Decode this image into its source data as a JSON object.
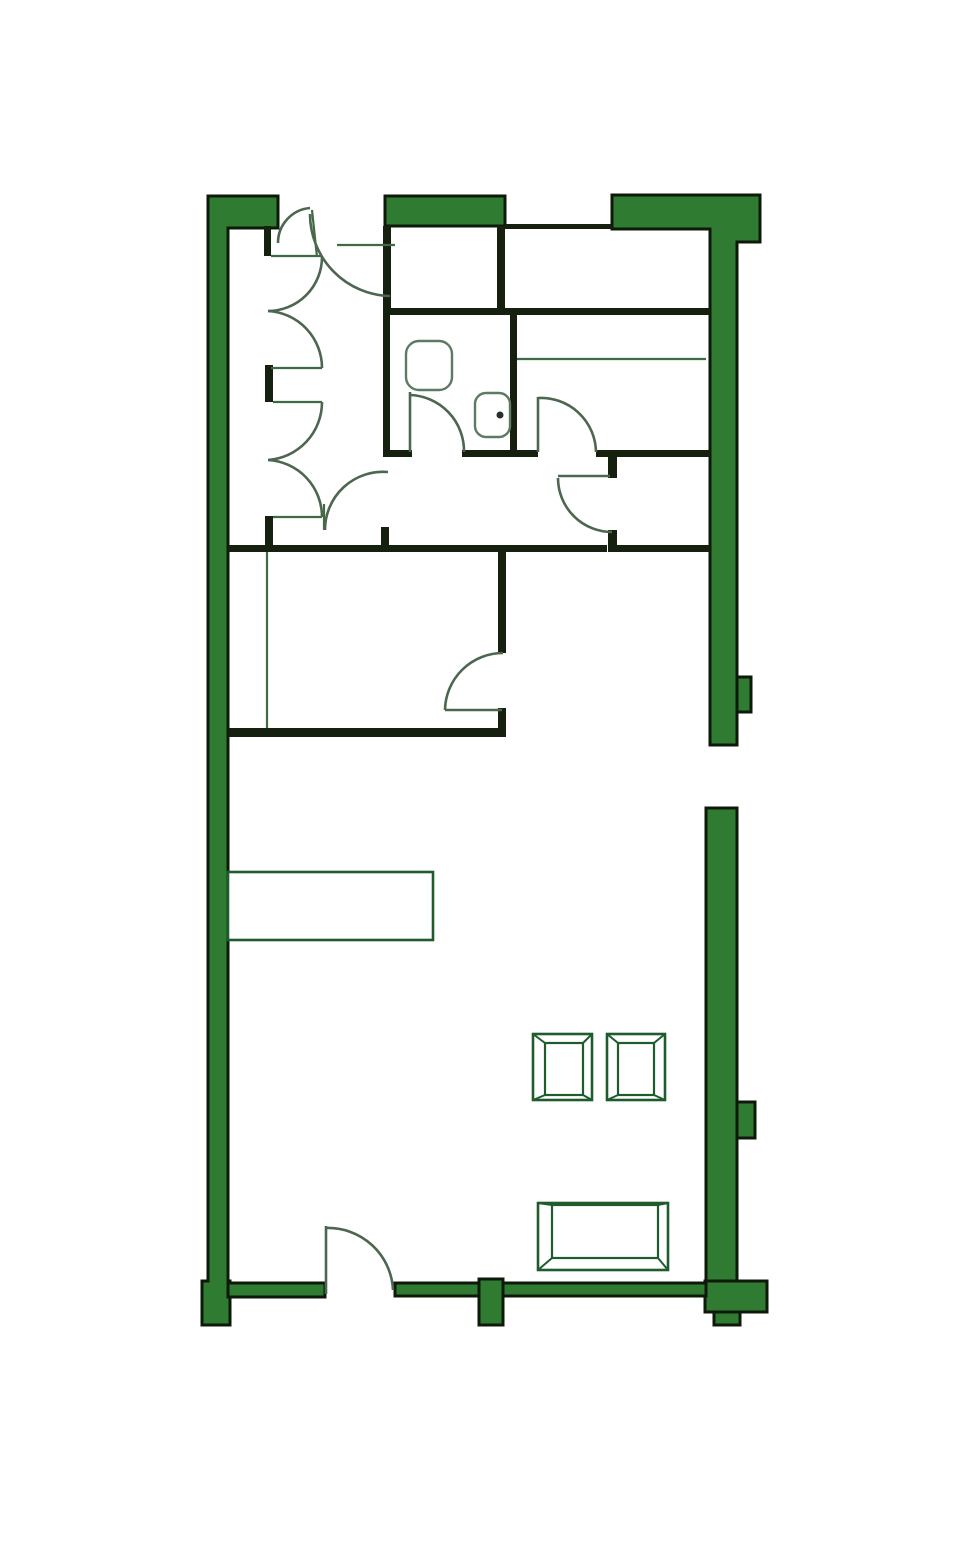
{
  "page": {
    "title": "apartment-floor-plan",
    "background": "#ffffff",
    "width": 980,
    "height": 1568
  },
  "colors": {
    "wall_fill": "#2e7b31",
    "wall_stroke": "#0e1a09",
    "interior_wall": "#16200f",
    "thin_line": "#3f6b43",
    "door": "#4d664f",
    "fixture": "#5d7a62",
    "furniture": "#1f5c2d",
    "faucet_dot": "#26302a",
    "fill_none": "none",
    "white": "#ffffff"
  },
  "floor_plan": {
    "green_walls": [
      {
        "name": "wall-left-exterior",
        "path": "M208,196 L278,196 L278,228 L228,228 L228,1281 L230,1281 L230,1325 L202,1325 L202,1281 L208,1281 Z"
      },
      {
        "name": "wall-top-middle-bar",
        "rect": [
          385,
          196,
          120,
          30
        ]
      },
      {
        "name": "wall-top-right-exterior",
        "path": "M612,195 L760,195 L760,242 L737,242 L737,745 L710,745 L710,229 L612,229 Z"
      },
      {
        "name": "wall-right-pier-upper",
        "rect": [
          737,
          677,
          14,
          35
        ]
      },
      {
        "name": "wall-right-lower-exterior",
        "rect": [
          706,
          808,
          31,
          475
        ]
      },
      {
        "name": "wall-right-pier-lower",
        "rect": [
          737,
          1102,
          18,
          36
        ]
      },
      {
        "name": "wall-right-foot",
        "rect": [
          705,
          1281,
          62,
          31
        ]
      },
      {
        "name": "wall-right-foot-tab",
        "rect": [
          714,
          1312,
          26,
          13
        ]
      },
      {
        "name": "wall-bottom-left",
        "rect": [
          228,
          1283,
          97,
          14
        ]
      },
      {
        "name": "wall-bottom-right",
        "rect": [
          395,
          1283,
          311,
          13
        ]
      },
      {
        "name": "wall-bottom-pier",
        "rect": [
          479,
          1279,
          24,
          46
        ]
      }
    ],
    "interior_walls": [
      {
        "name": "closetbox-left-wall",
        "rect": [
          383,
          226,
          8,
          89
        ]
      },
      {
        "name": "closetbox-right-wall",
        "rect": [
          497,
          226,
          8,
          89
        ]
      },
      {
        "name": "top-strip-wall",
        "rect": [
          505,
          224,
          107,
          5
        ]
      },
      {
        "name": "mid-horizontal-wall",
        "rect": [
          391,
          308,
          319,
          7
        ]
      },
      {
        "name": "bath-left-wall",
        "rect": [
          383,
          315,
          7,
          142
        ]
      },
      {
        "name": "bath-right-wall",
        "rect": [
          510,
          315,
          7,
          142
        ]
      },
      {
        "name": "hall-top-wall-a",
        "rect": [
          383,
          450,
          29,
          7
        ]
      },
      {
        "name": "hall-top-wall-b",
        "rect": [
          462,
          450,
          76,
          7
        ]
      },
      {
        "name": "hall-top-wall-c",
        "rect": [
          596,
          450,
          114,
          7
        ]
      },
      {
        "name": "hall-stub-upper",
        "rect": [
          608,
          457,
          9,
          21
        ]
      },
      {
        "name": "hall-bottom-wall-a",
        "rect": [
          228,
          545,
          154,
          7
        ]
      },
      {
        "name": "hall-stub-left",
        "rect": [
          381,
          527,
          8,
          25
        ]
      },
      {
        "name": "hall-bottom-wall-b",
        "rect": [
          389,
          545,
          218,
          7
        ]
      },
      {
        "name": "hall-stub-lower",
        "rect": [
          608,
          530,
          9,
          22
        ]
      },
      {
        "name": "hall-bottom-wall-c",
        "rect": [
          617,
          545,
          93,
          7
        ]
      },
      {
        "name": "room-right-wall-upper",
        "rect": [
          498,
          552,
          8,
          101
        ]
      },
      {
        "name": "room-right-wall-lower",
        "rect": [
          498,
          708,
          8,
          29
        ]
      },
      {
        "name": "room-bottom-wall",
        "rect": [
          228,
          728,
          278,
          9
        ]
      },
      {
        "name": "closet-stub-a",
        "rect": [
          264,
          226,
          7,
          30
        ]
      },
      {
        "name": "closet-stub-b",
        "rect": [
          265,
          365,
          8,
          37
        ]
      },
      {
        "name": "closet-stub-c",
        "rect": [
          265,
          516,
          8,
          31
        ]
      }
    ],
    "thin_lines": [
      {
        "name": "closet-jamb-line-1",
        "line": [
          271,
          256,
          322,
          256
        ]
      },
      {
        "name": "closet-jamb-line-2",
        "line": [
          271,
          368,
          322,
          368
        ]
      },
      {
        "name": "closet-jamb-line-3",
        "line": [
          273,
          402,
          322,
          402
        ]
      },
      {
        "name": "closet-jamb-line-4",
        "line": [
          273,
          517,
          322,
          517
        ]
      },
      {
        "name": "entry-header-line",
        "line": [
          337,
          245,
          395,
          245
        ]
      },
      {
        "name": "entry-cusp-line",
        "line": [
          312,
          210,
          317,
          257
        ]
      },
      {
        "name": "bed-line",
        "line": [
          517,
          359,
          706,
          359
        ]
      },
      {
        "name": "room-divider-line",
        "line": [
          267,
          552,
          267,
          728
        ]
      },
      {
        "name": "hall-door-tick",
        "line": [
          324,
          504,
          324,
          530
        ]
      }
    ],
    "door_leaves": [
      {
        "name": "bath-door-leaf",
        "line": [
          410,
          392,
          410,
          452
        ]
      },
      {
        "name": "bedroom-door-leaf",
        "line": [
          538,
          397,
          538,
          452
        ]
      },
      {
        "name": "hall-closet-door-leaf",
        "line": [
          558,
          476,
          610,
          476
        ]
      },
      {
        "name": "room-door-leaf",
        "line": [
          445,
          710,
          502,
          710
        ]
      },
      {
        "name": "patio-door-leaf",
        "line": [
          326,
          1226,
          326,
          1294
        ]
      }
    ],
    "door_arcs": [
      {
        "name": "entry-door-arc-small",
        "path": "M310,208 A35,35 0 0 0 278,243"
      },
      {
        "name": "entry-door-arc-large",
        "path": "M310,214 A82,82 0 0 0 390,296"
      },
      {
        "name": "closet-bifold-arc-1a",
        "path": "M322,257 A54,54 0 0 1 268,311"
      },
      {
        "name": "closet-bifold-arc-1b",
        "path": "M268,311 A57,57 0 0 1 322,368"
      },
      {
        "name": "closet-bifold-arc-2a",
        "path": "M322,402 A58,58 0 0 1 268,460"
      },
      {
        "name": "closet-bifold-arc-2b",
        "path": "M268,460 A57,57 0 0 1 322,517"
      },
      {
        "name": "bath-door-arc",
        "path": "M410,395 A56,56 0 0 1 464,452"
      },
      {
        "name": "bedroom-door-arc",
        "path": "M538,398 A55,55 0 0 1 596,452"
      },
      {
        "name": "hall-closet-door-arc",
        "path": "M558,478 A54,54 0 0 0 612,532"
      },
      {
        "name": "hall-left-door-arc",
        "path": "M388,472 A58,58 0 0 0 325,530"
      },
      {
        "name": "room-door-arc",
        "path": "M445,710 A58,58 0 0 1 503,653"
      },
      {
        "name": "patio-door-arc",
        "path": "M326,1228 A65,65 0 0 1 393,1290"
      }
    ],
    "fixtures": [
      {
        "name": "toilet",
        "rect": [
          406,
          341,
          46,
          49
        ],
        "rx": 13
      },
      {
        "name": "sink",
        "rect": [
          475,
          393,
          35,
          44
        ],
        "rx": 11
      },
      {
        "name": "sink-faucet-dot",
        "circle": [
          500,
          415,
          3.5
        ]
      }
    ],
    "furniture": [
      {
        "name": "counter",
        "type": "rect",
        "rect": [
          228,
          872,
          205,
          68
        ]
      },
      {
        "name": "chair-1",
        "type": "frame",
        "outer": [
          533,
          1034,
          59,
          66
        ],
        "inner": [
          545,
          1043,
          38,
          52
        ]
      },
      {
        "name": "chair-2",
        "type": "frame",
        "outer": [
          607,
          1034,
          58,
          66
        ],
        "inner": [
          618,
          1043,
          36,
          52
        ]
      },
      {
        "name": "table",
        "type": "frame",
        "outer": [
          538,
          1203,
          130,
          67
        ],
        "inner": [
          552,
          1205,
          106,
          53
        ]
      }
    ]
  }
}
